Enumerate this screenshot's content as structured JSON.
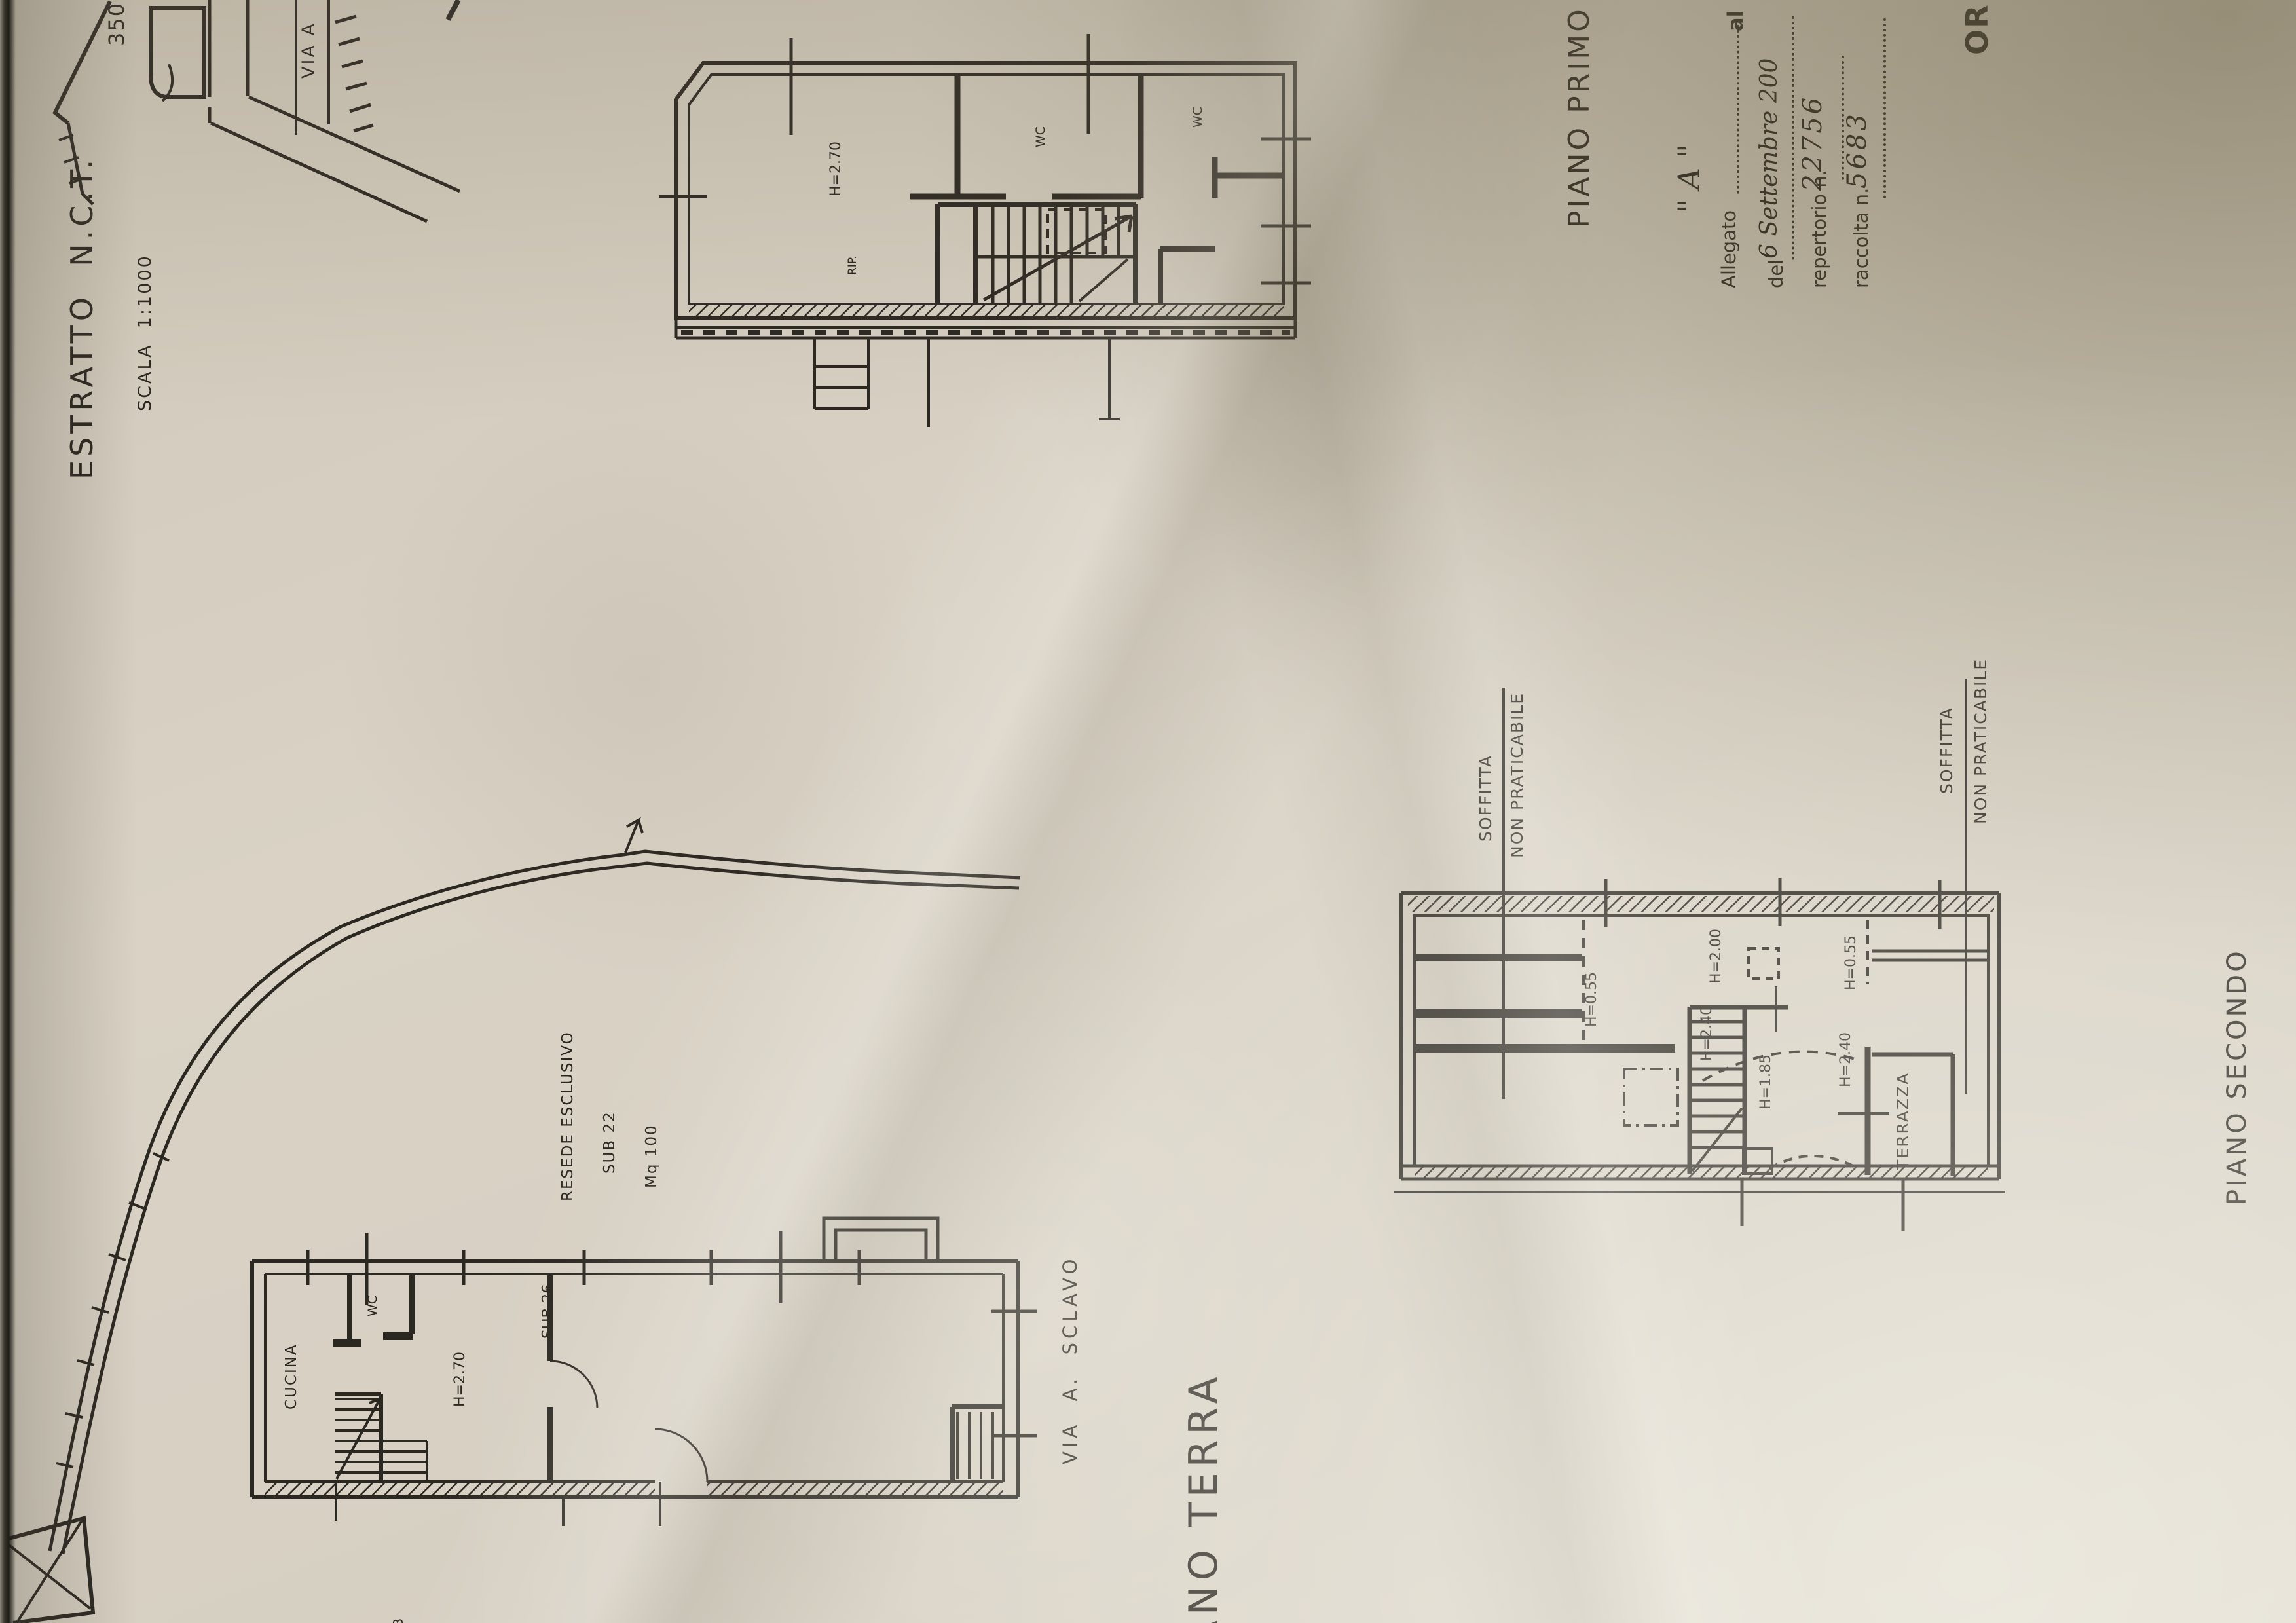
{
  "map_extract": {
    "title": "ESTRATTO  N.C.T.",
    "scale": "SCALA  1:1000",
    "parcel": "350",
    "street": "VIA A"
  },
  "stamp_fragment": "OR",
  "attachment": {
    "allegato_label": "Allegato",
    "letter": "\" A \"",
    "suffix": "al",
    "del_label": "del",
    "date": "6 Settembre 200",
    "repertorio_label": "repertorio n.",
    "repertorio_number": "22756",
    "raccolta_label": "raccolta n.",
    "raccolta_number": "5683"
  },
  "first_floor": {
    "title": "PIANO PRIMO",
    "height": "H=2.70",
    "wc_1": "WC",
    "wc_2": "WC",
    "storage": "RIP."
  },
  "ground_floor": {
    "title": "PIANO TERRA",
    "kitchen": "CUCINA",
    "wc": "WC",
    "height": "H=2.70",
    "sub_right": "SUB 26",
    "resede": "RESEDE ESCLUSIVO",
    "sub": "SUB 22",
    "area": "Mq 100",
    "street": "VIA  A.  SCLAVO",
    "edge_fragment": "SUB"
  },
  "second_floor": {
    "title": "PIANO SECONDO",
    "soffitta": "SOFFITTA",
    "non_praticabile": "NON PRATICABILE",
    "h_055": "H=0.55",
    "h_200": "H=2.00",
    "h_240": "H=2.40",
    "h_185": "H=1.85",
    "terrace": "TERRAZZA"
  }
}
